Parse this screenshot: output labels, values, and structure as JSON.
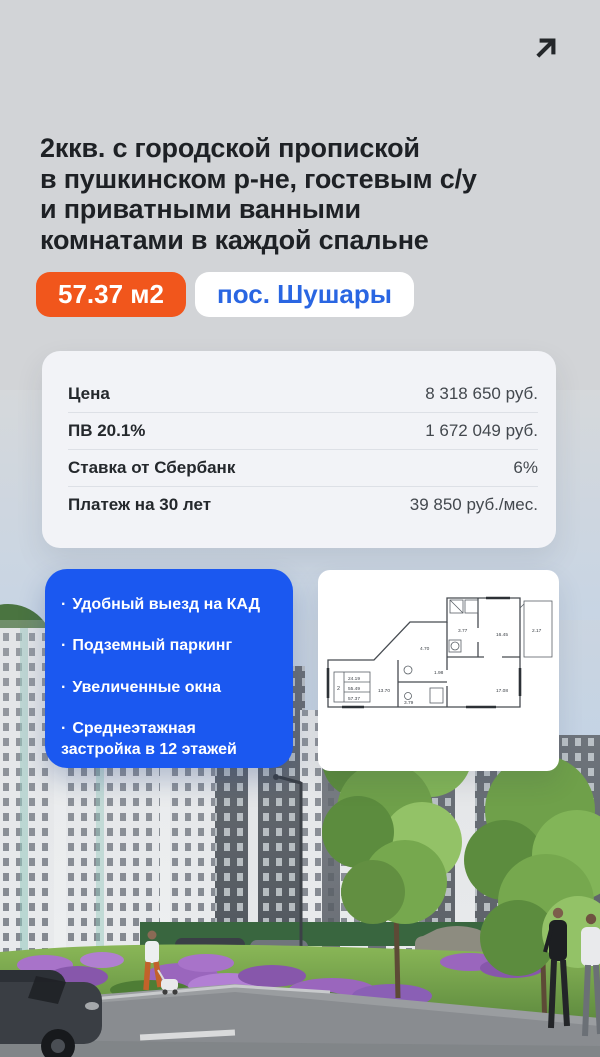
{
  "icons": {
    "share": "arrow-up-right"
  },
  "header": {
    "title_lines": [
      "2ккв. с городской пропиской",
      "в пушкинском р-не, гостевым с/у",
      "и приватными ванными",
      "комнатами в каждой спальне"
    ]
  },
  "badges": {
    "area": "57.37 м2",
    "location": "пос. Шушары"
  },
  "price_card": {
    "rows": [
      {
        "label": "Цена",
        "value": "8 318 650 руб."
      },
      {
        "label": "ПВ 20.1%",
        "value": "1 672 049 руб."
      },
      {
        "label": "Ставка от Сбербанк",
        "value": "6%"
      },
      {
        "label": "Платеж на 30 лет",
        "value": "39 850 руб./мес."
      }
    ]
  },
  "features_card": {
    "bullet": "·",
    "items": [
      "Удобный выезд на КАД",
      "Подземный паркинг",
      "Увеличенные окна",
      "Среднеэтажная застройка в 12 этажей"
    ]
  },
  "floor_plan": {
    "rooms": "2",
    "area_living": "24.19",
    "area_main": "55.49",
    "area_total": "57.37",
    "labels": {
      "bath_top": "3.77",
      "bedroom": "16.45",
      "balcony": "2.17",
      "hall": "4.70",
      "wc": "1.98",
      "bath": "3.79",
      "room_left": "13.70",
      "living": "17.08"
    }
  },
  "colors": {
    "accent_orange": "#f1561c",
    "accent_blue": "#1b58f0",
    "location_text_blue": "#2a66e2",
    "title_text": "#1e2125",
    "top_background": "#d2d4d7",
    "card_background": "#f2f3f7"
  }
}
